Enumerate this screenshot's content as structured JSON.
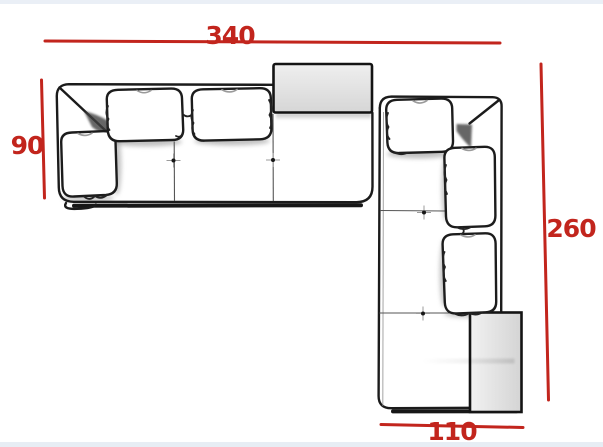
{
  "page": {
    "background": "#ffffff",
    "top_strip_color": "#eaeff6",
    "bottom_strip_color": "#e7edf4"
  },
  "diagram": {
    "type": "furniture floor-plan dimension drawing",
    "subject": "L-shaped sectional corner sofa, top view",
    "accent_color": "#c2251d",
    "outline_color": "#1b1b1b",
    "table_fill_color": "#dedede",
    "dimensions": {
      "top": {
        "label": "340"
      },
      "left": {
        "label": "90"
      },
      "right": {
        "label": "260"
      },
      "bottom": {
        "label": "110"
      }
    }
  }
}
